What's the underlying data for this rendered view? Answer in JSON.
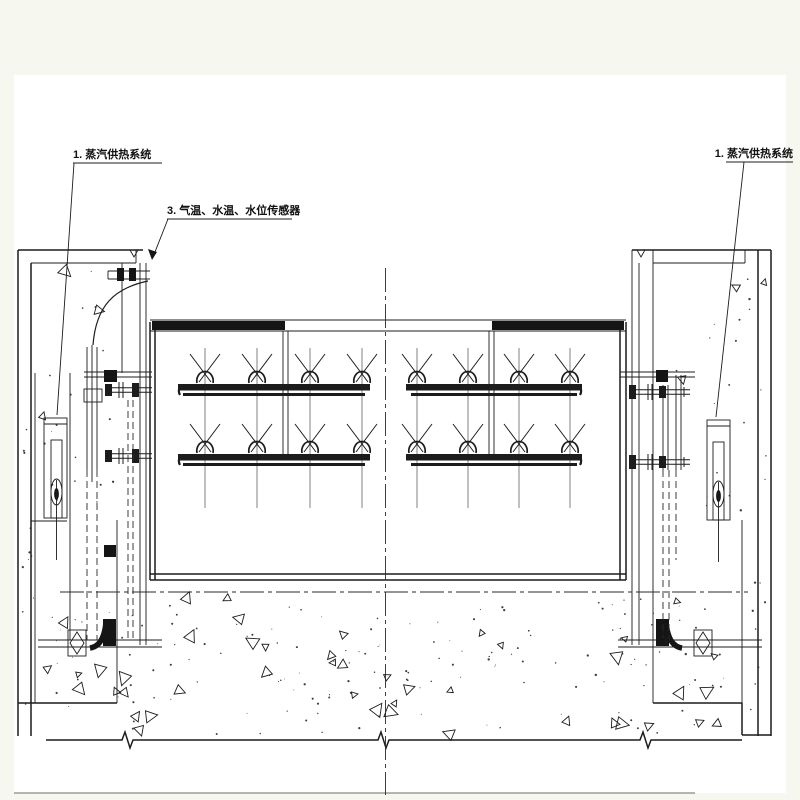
{
  "drawing_type": "engineering-section-drawing",
  "labels": {
    "steam_system_left": "1. 蒸汽供热系统",
    "sensors": "3. 气温、水温、水位传感器",
    "steam_system_right": "1. 蒸汽供热系统"
  },
  "colors": {
    "ink": "#1c1c1c",
    "paper": "#ffffff",
    "margin": "#f6f8f0"
  }
}
